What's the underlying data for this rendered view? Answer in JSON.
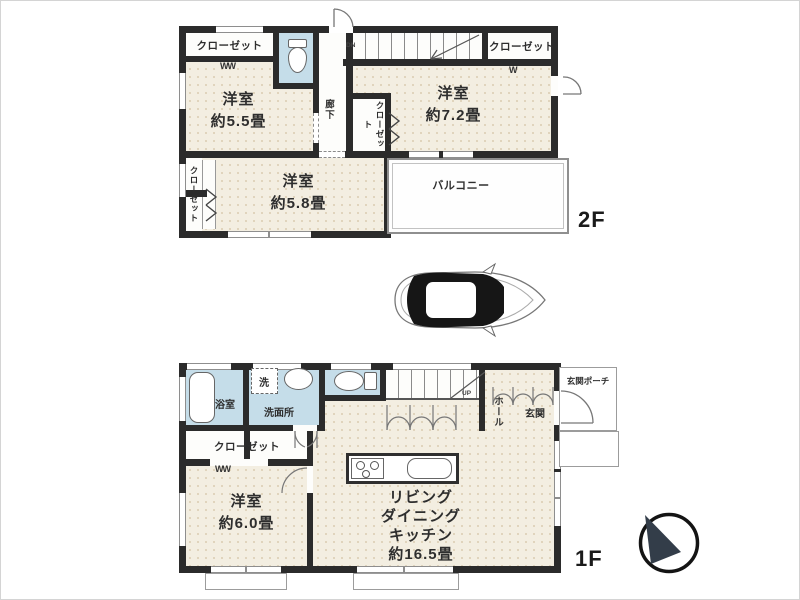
{
  "plan_title": "2-story house floor plan",
  "colors": {
    "wall": "#2b2b2b",
    "floor_cream": "#f3eee1",
    "wet_area_blue": "#c5dde9",
    "line_gray": "#8e8e8e"
  },
  "floor2": {
    "floor_label": "2F",
    "rooms": {
      "bedroom_55": {
        "name": "洋室",
        "area": "約5.5畳"
      },
      "bedroom_72": {
        "name": "洋室",
        "area": "約7.2畳"
      },
      "bedroom_58": {
        "name": "洋室",
        "area": "約5.8畳"
      }
    },
    "closet_top": "クローゼット",
    "closet_right": "クローゼット",
    "closet_mid": "クローゼット",
    "closet_left": "クローゼット",
    "hallway": "廊下",
    "balcony": "バルコニー",
    "stairs": "DN",
    "hanger_mark_double": "WW",
    "hanger_mark_single": "W"
  },
  "floor1": {
    "floor_label": "1F",
    "rooms": {
      "bath": "浴室",
      "laundry": "洗",
      "washroom": "洗面所",
      "bedroom_60": {
        "name": "洋室",
        "area": "約6.0畳"
      },
      "ldk": {
        "line1": "リビング",
        "line2": "ダイニング",
        "line3": "キッチン",
        "area": "約16.5畳"
      },
      "hall": "ホール",
      "entrance": "玄関",
      "porch": "玄関ポーチ"
    },
    "closet": "クローゼット",
    "stairs": "UP",
    "hanger_mark": "WW"
  }
}
